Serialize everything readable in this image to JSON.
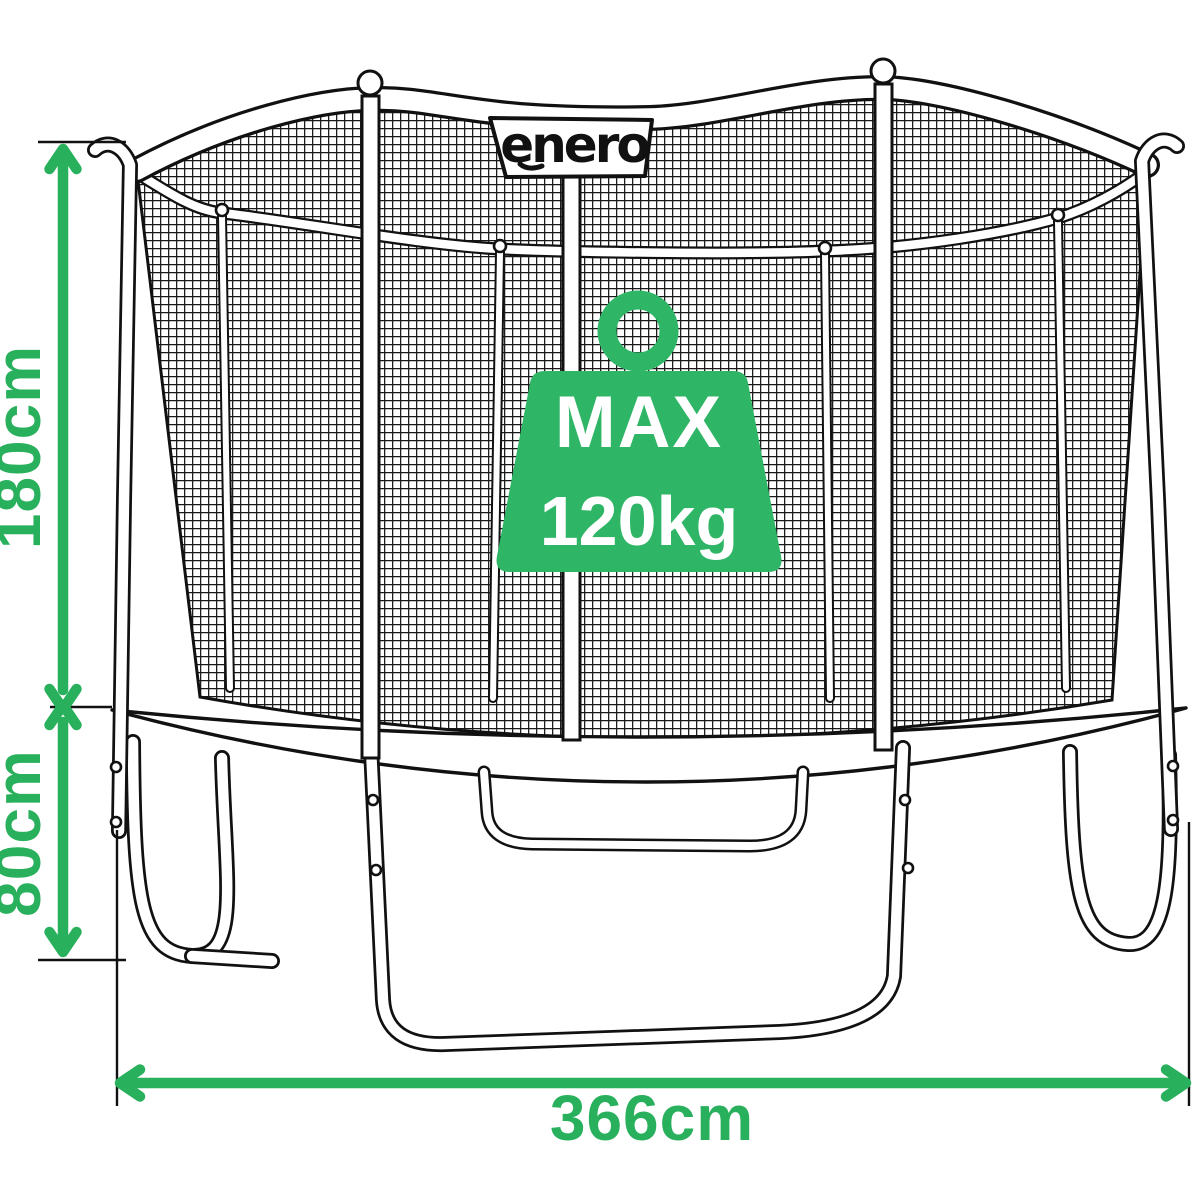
{
  "diagram": {
    "brand_label": "enero",
    "weight_badge": {
      "line1": "MAX",
      "line2": "120kg"
    },
    "dimensions": {
      "net_height": "180cm",
      "frame_height": "80cm",
      "total_width": "366cm"
    }
  },
  "colors": {
    "badge_green": "#2fb566",
    "dimension_green": "#29b05c",
    "outline": "#111111",
    "background": "#ffffff"
  }
}
